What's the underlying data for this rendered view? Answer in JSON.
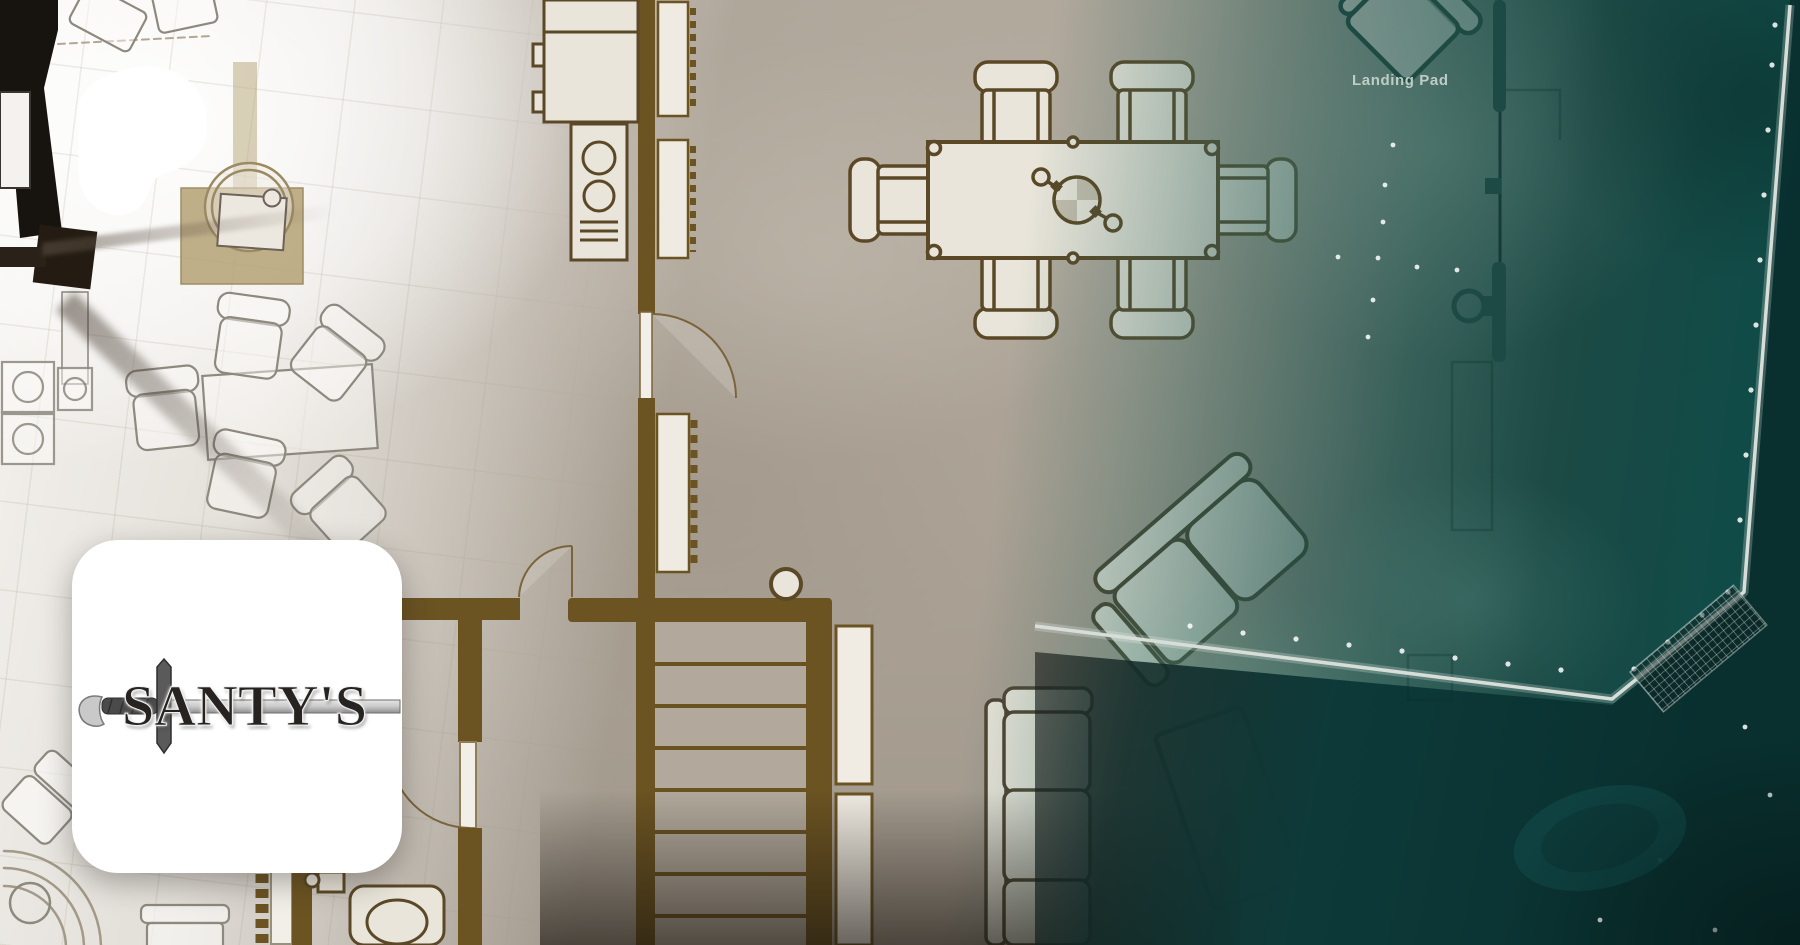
{
  "banner": {
    "patreon_logo": {
      "icon": "patreon-logo",
      "color": "#ffffff"
    },
    "creator_tile": {
      "name": "SANTY'S",
      "icon": "sword-icon",
      "bg": "#ffffff"
    },
    "floorplan": {
      "labels": {
        "landing_pad": "Landing Pad"
      },
      "palette": {
        "floor": "#aba295",
        "left_floor": "#f0eeea",
        "wall_brown": "#6b5322",
        "black_wall": "#17130e",
        "furniture_fill": "#e9e5da",
        "furniture_outline": "#5a4826",
        "tan_desk": "#b5a376",
        "deck_teal": "#1b5650",
        "water_dark": "#0a2f2f",
        "railing": "#d7ded8",
        "label_text": "#c8d5ce"
      },
      "furniture": {
        "kitchen": [
          "refrigerator",
          "stove"
        ],
        "dining_table": {
          "seats": 6,
          "emblem": "compass-emblem"
        },
        "living_room": [
          "sofa",
          "loveseat",
          "coffee-table"
        ],
        "office": [
          "desk-rug",
          "office-table",
          "office-chairs",
          "washer-dryer",
          "chaise"
        ],
        "bathroom": [
          "toilet",
          "sink"
        ],
        "stairs": {
          "steps": 7
        },
        "deck": [
          "armchair",
          "mast-pole",
          "grate",
          "deck-lights",
          "rock"
        ]
      }
    }
  }
}
